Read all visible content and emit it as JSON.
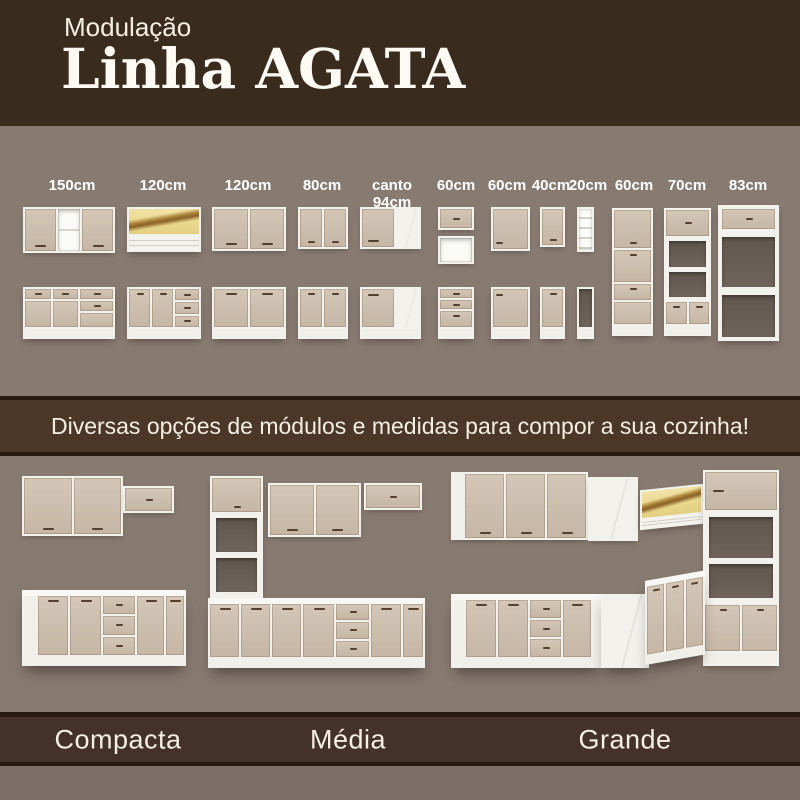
{
  "header": {
    "kicker": "Modulação",
    "title": "Linha AGATA"
  },
  "modules": [
    {
      "size": "150cm"
    },
    {
      "size": "120cm"
    },
    {
      "size": "120cm"
    },
    {
      "size": "80cm"
    },
    {
      "size": "canto 94cm"
    },
    {
      "size": "60cm"
    },
    {
      "size": "60cm"
    },
    {
      "size": "40cm"
    },
    {
      "size": "20cm"
    },
    {
      "size": "60cm"
    },
    {
      "size": "70cm"
    },
    {
      "size": "83cm"
    }
  ],
  "banner": {
    "text": "Diversas opções de módulos e medidas para compor a sua cozinha!"
  },
  "kitchens": [
    {
      "label": "Compacta"
    },
    {
      "label": "Média"
    },
    {
      "label": "Grande"
    }
  ],
  "colors": {
    "header_bg": "#3a2b1f",
    "background": "#877a71",
    "background_bottom": "#7b6f67",
    "band_bg": "#4a3728",
    "band_edge": "#281a11",
    "label_band_bg": "#43312a",
    "text_cream": "#f5efe2",
    "door_light": "#d4c7b7",
    "door_dark": "#c5b6a5",
    "carcass_white": "#f2f1ec",
    "handle_brown": "#54402f",
    "opening_shadow": "#6f645b",
    "glass_yellow": "#ead98e",
    "glass_streak": "#a87e35"
  }
}
